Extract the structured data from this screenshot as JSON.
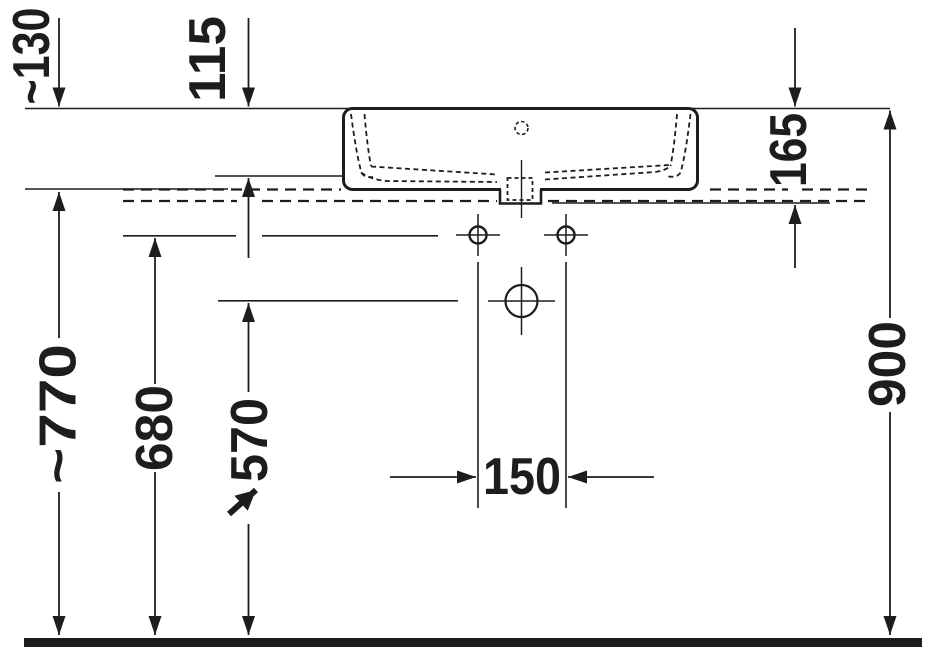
{
  "drawing": {
    "kind": "technical-dimension-drawing",
    "subject": "washbasin side elevation with mounting heights",
    "colors": {
      "line": "#1d1d1b",
      "background": "#ffffff"
    },
    "dimensions": {
      "d130": "~130",
      "d115": "115",
      "d165": "165",
      "d770": "~770",
      "d680": "680",
      "d570": "570",
      "d150": "150",
      "d900": "900"
    }
  }
}
